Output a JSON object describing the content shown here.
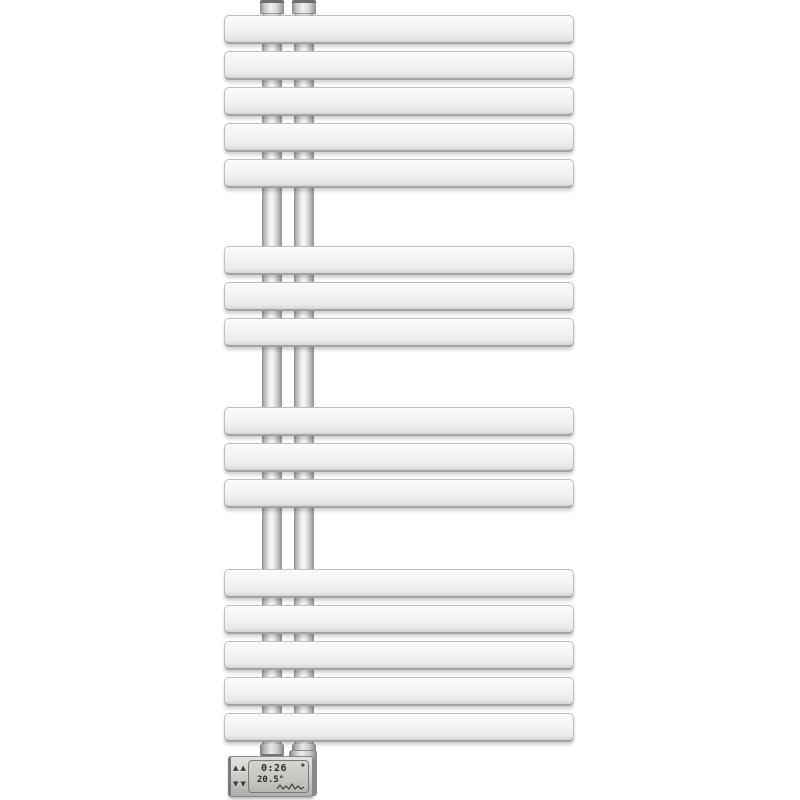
{
  "scene": {
    "background_color": "#ffffff",
    "description": "White designer electric towel radiator with flat horizontal bars, twin chrome risers and a digital heating controller at the bottom"
  },
  "radiator": {
    "bar_groups": [
      5,
      3,
      3,
      5
    ],
    "bar_count": 16,
    "colors": {
      "bar_face": "#f2f2f2",
      "bar_edge": "#a2a2a2",
      "tube_highlight": "#f8f8f8",
      "tube_shadow": "#8f8f8f"
    }
  },
  "controller": {
    "display": {
      "time": "0:26",
      "temperature": "20.5°"
    },
    "icons": {
      "up": "▲",
      "down": "▼",
      "status": "❖"
    }
  }
}
